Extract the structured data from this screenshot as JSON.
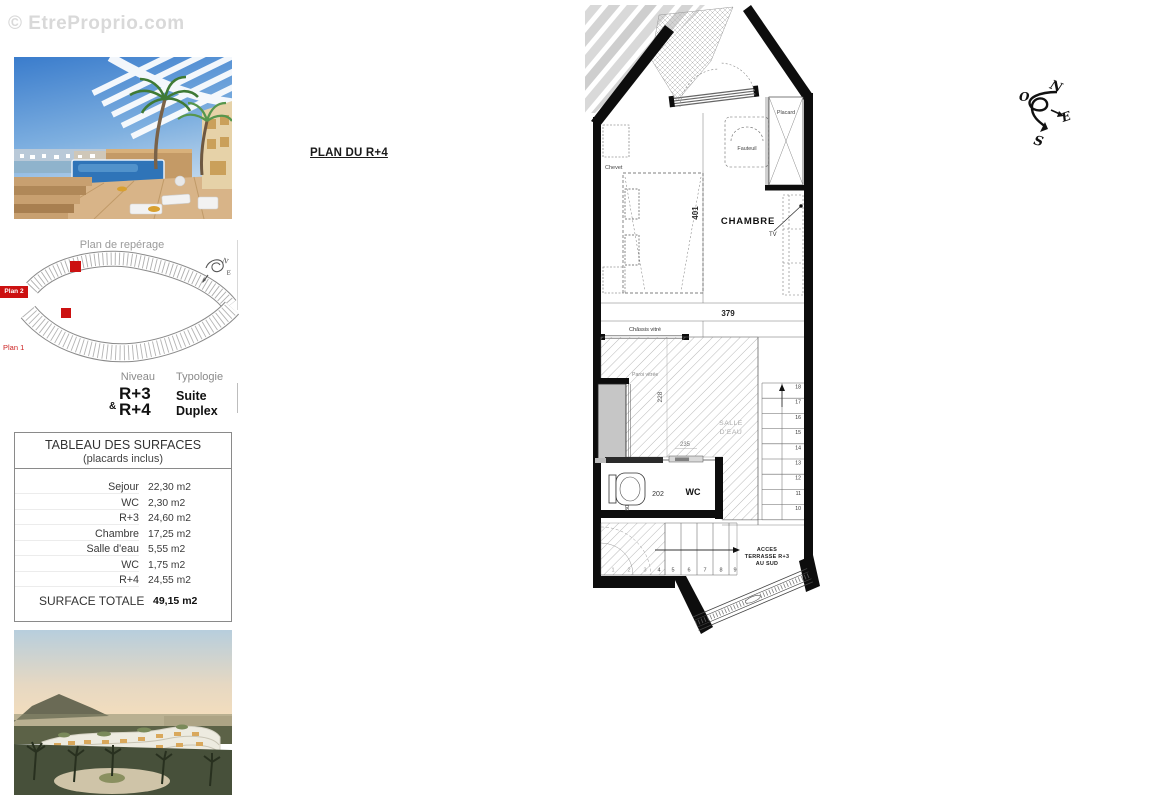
{
  "watermark": "© EtreProprio.com",
  "colors": {
    "accent_red": "#cc1111",
    "watermark_gray": "#d9d9d9"
  },
  "plan_title": "PLAN DU R+4",
  "reperage": {
    "title": "Plan de repérage",
    "plan2_badge": "Plan 2",
    "plan1_label": "Plan 1",
    "compass_n": "N",
    "compass_e": "E"
  },
  "unit_info": {
    "niveau_header": "Niveau",
    "typologie_header": "Typologie",
    "niveau_amp": "&",
    "niveau_line1": "R+3",
    "niveau_line2": "R+4",
    "typologie_line1": "Suite",
    "typologie_line2": "Duplex"
  },
  "surface_table": {
    "title": "TABLEAU DES SURFACES",
    "subtitle": "(placards inclus)",
    "rows": [
      {
        "label": "Sejour",
        "value": "22,30 m2"
      },
      {
        "label": "WC",
        "value": "2,30 m2"
      },
      {
        "label": "R+3",
        "value": "24,60 m2"
      },
      {
        "label": "Chambre",
        "value": "17,25 m2"
      },
      {
        "label": "Salle d'eau",
        "value": "5,55 m2"
      },
      {
        "label": "WC",
        "value": "1,75 m2"
      },
      {
        "label": "R+4",
        "value": "24,55 m2"
      }
    ],
    "total_label": "SURFACE TOTALE",
    "total_value": "49,15 m2"
  },
  "floor_plan": {
    "room_labels": {
      "chambre": "CHAMBRE",
      "salle_eau_line1": "SALLE",
      "salle_eau_line2": "D'EAU",
      "wc": "WC"
    },
    "furniture_labels": {
      "chevet": "Chevet",
      "fauteuil": "Fauteuil",
      "placard": "Placard",
      "tv": "TV"
    },
    "feature_labels": {
      "chassis_vitre": "Châssis vitré",
      "paroi_vitree": "Paroi vitrée",
      "acces_line1": "ACCES",
      "acces_line2": "TERRASSE R+3",
      "acces_line3": "AU SUD"
    },
    "dimensions": {
      "d401": "401",
      "d379": "379",
      "d228": "228",
      "d235": "235",
      "d202": "202",
      "d80": "80"
    },
    "stairs_upper": [
      "18",
      "17",
      "16",
      "15",
      "14",
      "13",
      "12",
      "11",
      "10"
    ],
    "stairs_lower": [
      "1",
      "2",
      "3",
      "4",
      "5",
      "6",
      "7",
      "8",
      "9"
    ]
  },
  "compass": {
    "n": "N",
    "s": "S",
    "e": "E",
    "o": "O"
  }
}
